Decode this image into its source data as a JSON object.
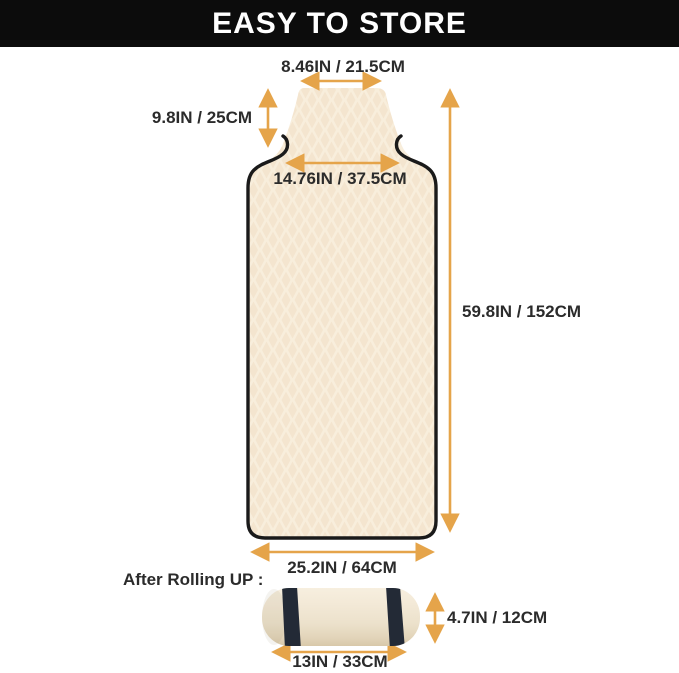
{
  "banner": {
    "title": "EASY TO STORE"
  },
  "dimensions": {
    "headrest_width": "8.46IN / 21.5CM",
    "headrest_height": "9.8IN / 25CM",
    "neck_width": "14.76IN / 37.5CM",
    "body_height": "59.8IN / 152CM",
    "body_width": "25.2IN / 64CM",
    "roll_height": "4.7IN / 12CM",
    "roll_width": "13IN / 33CM"
  },
  "rolled_label": "After Rolling UP :",
  "colors": {
    "banner_bg": "#0c0c0c",
    "banner_fg": "#ffffff",
    "text": "#2b2b2b",
    "arrow": "#e5a44a",
    "towel_base": "#f8eedc",
    "towel_pattern": "#f1dfc6",
    "outline": "#1a1a1a",
    "roll_fill": "#efe5d2",
    "strap": "#232a36"
  }
}
